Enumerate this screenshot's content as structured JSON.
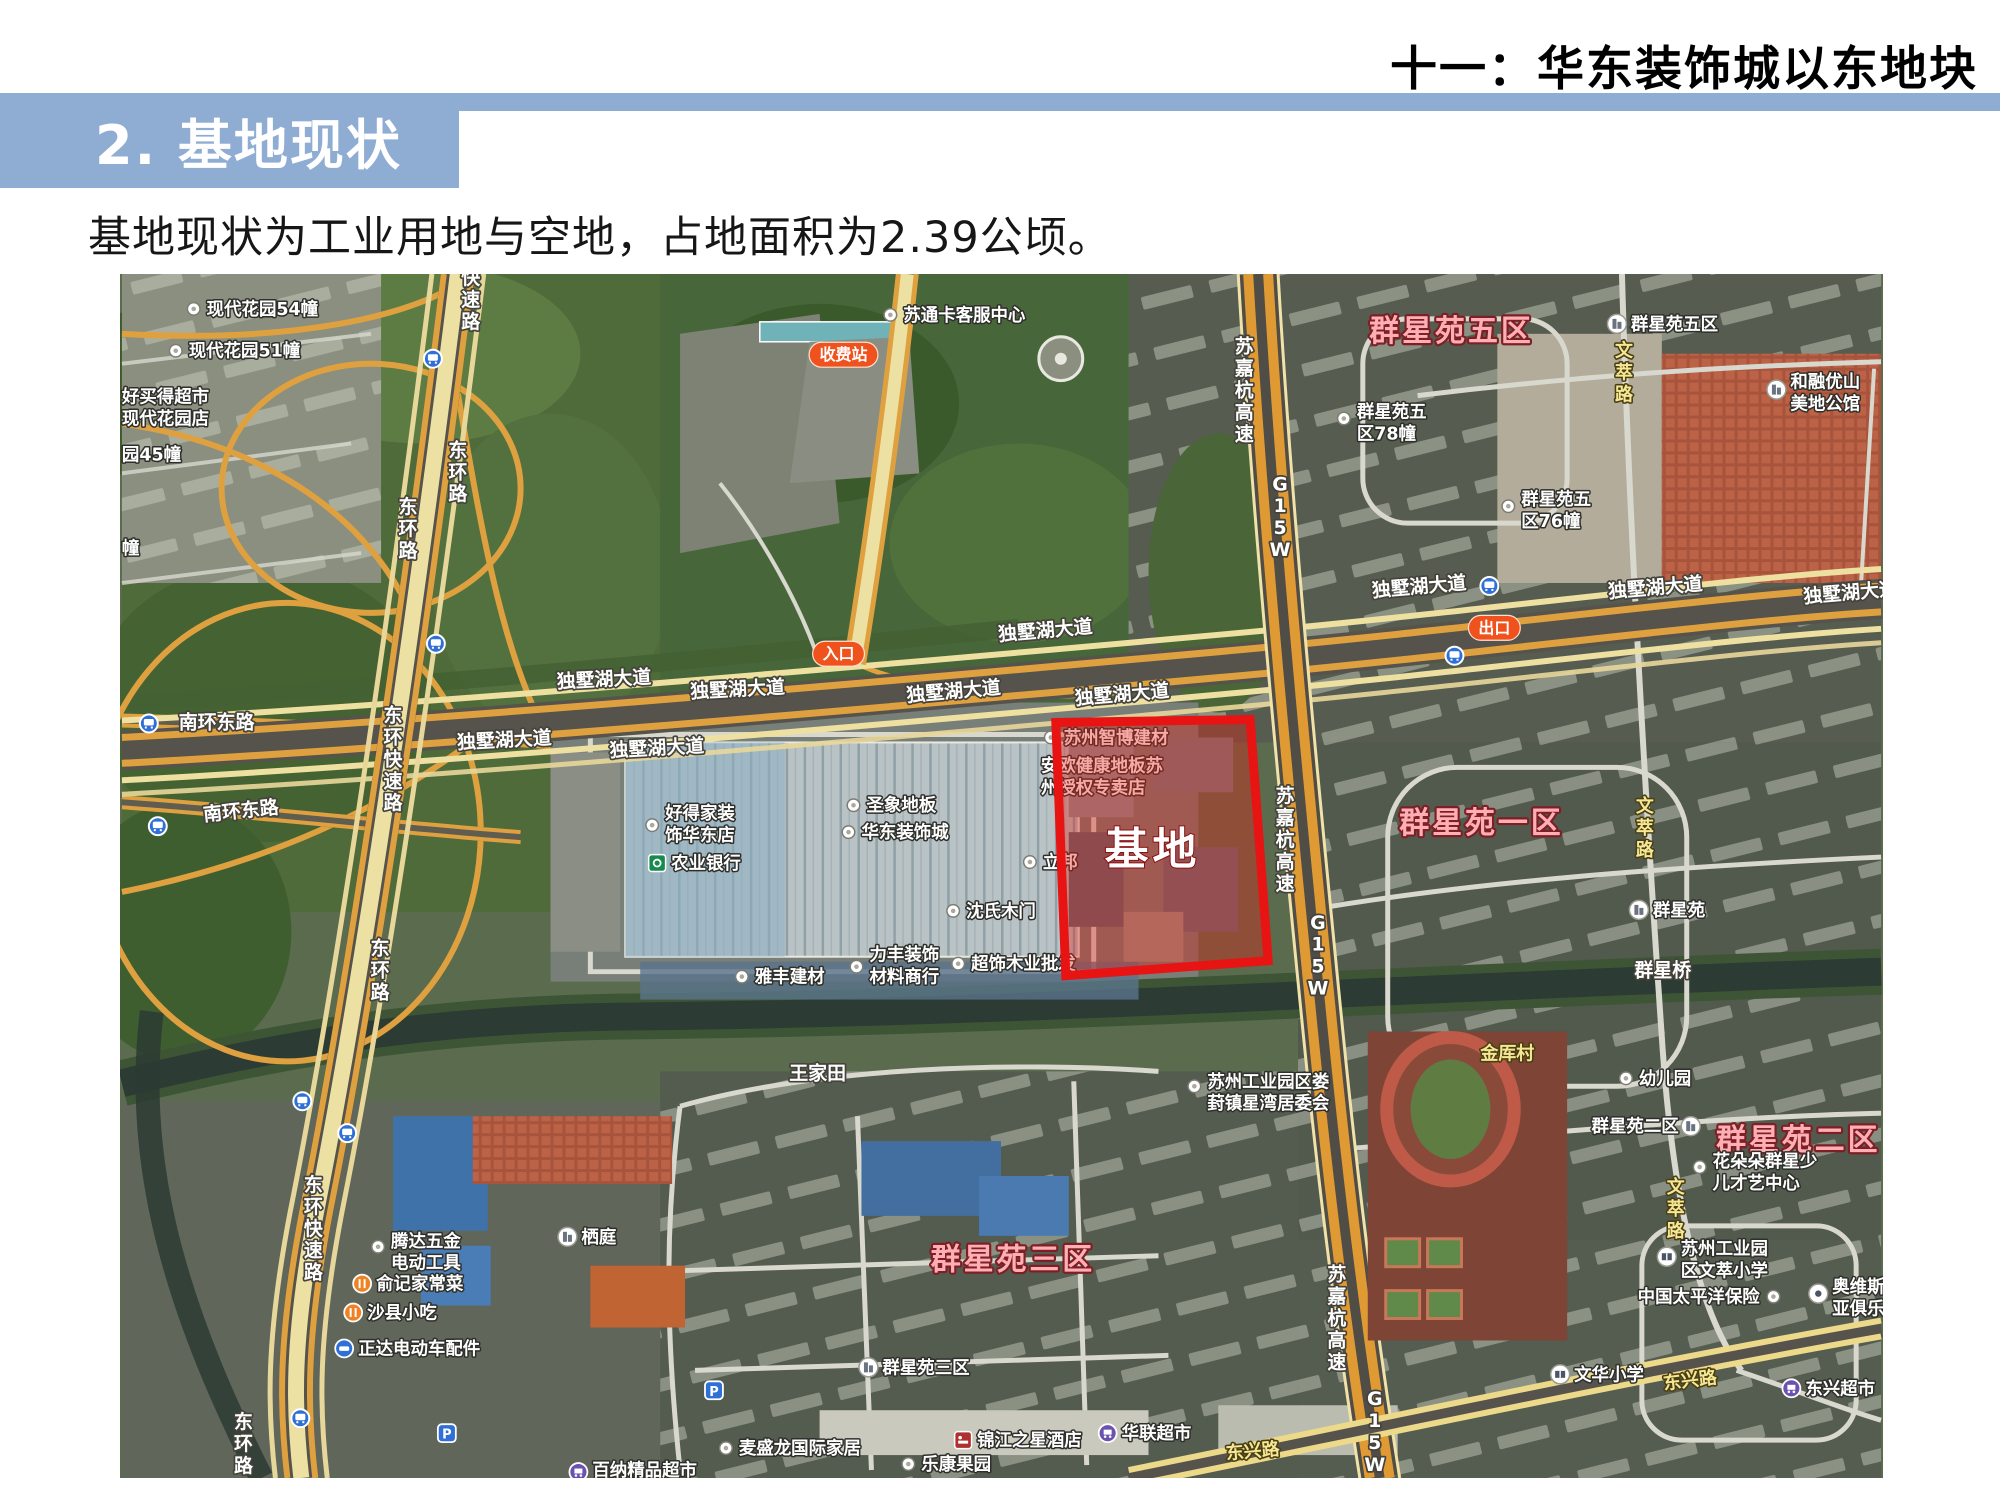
{
  "header": {
    "title": "十一：华东装饰城以东地块"
  },
  "banner": {
    "title": "2. 基地现状"
  },
  "body": {
    "text": "基地现状为工业用地与空地，占地面积为2.39公顷。"
  },
  "colors": {
    "banner_blue": "#8FACD3",
    "site_red": "#E81313",
    "road_orange": "#DFA13F"
  },
  "site": {
    "label": "基地",
    "points": "937,450 1132,447 1150,689 947,704",
    "label_x": 1034,
    "label_y": 592,
    "border_color": "#e81313",
    "fill_color": "rgba(228,32,22,0.38)"
  },
  "map": {
    "badges": [
      {
        "n": "toll-station-badge",
        "t": "收费站",
        "x": 724,
        "y": 81
      },
      {
        "n": "entrance-badge",
        "t": "入口",
        "x": 719,
        "y": 381
      },
      {
        "n": "exit-badge",
        "t": "出口",
        "x": 1377,
        "y": 355
      }
    ],
    "labels": [
      {
        "t": "独墅湖大道",
        "x": 484,
        "y": 413,
        "k": "road",
        "r": -3
      },
      {
        "t": "独墅湖大道",
        "x": 618,
        "y": 423,
        "k": "road",
        "r": -3
      },
      {
        "t": "独墅湖大道",
        "x": 835,
        "y": 425,
        "k": "road",
        "r": -5
      },
      {
        "t": "独墅湖大道",
        "x": 1004,
        "y": 428,
        "k": "road",
        "r": -5
      },
      {
        "t": "独墅湖大道",
        "x": 927,
        "y": 364,
        "k": "road",
        "r": -5
      },
      {
        "t": "独墅湖大道",
        "x": 1302,
        "y": 320,
        "k": "road",
        "r": -5
      },
      {
        "t": "独墅湖大道",
        "x": 1539,
        "y": 321,
        "k": "road",
        "r": -5
      },
      {
        "t": "独墅湖大道",
        "x": 1735,
        "y": 326,
        "k": "road",
        "r": -5
      },
      {
        "t": "独墅湖大道",
        "x": 384,
        "y": 474,
        "k": "road",
        "r": -3
      },
      {
        "t": "独墅湖大道",
        "x": 537,
        "y": 482,
        "k": "road",
        "r": -3
      },
      {
        "t": "南环东路",
        "x": 95,
        "y": 456,
        "k": "road"
      },
      {
        "t": "南环东路",
        "x": 120,
        "y": 545,
        "k": "road",
        "r": -6
      },
      {
        "t": "王家田",
        "x": 698,
        "y": 808,
        "k": "road"
      },
      {
        "t": "群星桥",
        "x": 1546,
        "y": 705,
        "k": "road"
      },
      {
        "t": "快速路",
        "x": 350,
        "y": 32,
        "k": "road",
        "v": 1
      },
      {
        "t": "东环路",
        "x": 337,
        "y": 205,
        "k": "road",
        "v": 1
      },
      {
        "t": "东环路",
        "x": 287,
        "y": 262,
        "k": "road",
        "v": 1
      },
      {
        "t": "东环快速路",
        "x": 272,
        "y": 493,
        "k": "road",
        "v": 1
      },
      {
        "t": "东环路",
        "x": 259,
        "y": 705,
        "k": "road",
        "v": 1
      },
      {
        "t": "东环快速路",
        "x": 192,
        "y": 964,
        "k": "road",
        "v": 1
      },
      {
        "t": "东环路",
        "x": 122,
        "y": 1180,
        "k": "road",
        "v": 1
      },
      {
        "t": "苏嘉杭高速",
        "x": 1126,
        "y": 123,
        "k": "road",
        "v": 1
      },
      {
        "t": "G15W",
        "x": 1162,
        "y": 250,
        "k": "road",
        "v": 1
      },
      {
        "t": "苏嘉杭高速",
        "x": 1167,
        "y": 574,
        "k": "road",
        "v": 1
      },
      {
        "t": "G15W",
        "x": 1200,
        "y": 690,
        "k": "road",
        "v": 1
      },
      {
        "t": "苏嘉杭高速",
        "x": 1219,
        "y": 1054,
        "k": "road",
        "v": 1
      },
      {
        "t": "G15W",
        "x": 1257,
        "y": 1168,
        "k": "road",
        "v": 1
      },
      {
        "t": "文萃路",
        "x": 1507,
        "y": 105,
        "k": "minor",
        "v": 1
      },
      {
        "t": "文萃路",
        "x": 1528,
        "y": 562,
        "k": "minor",
        "v": 1
      },
      {
        "t": "文萃路",
        "x": 1559,
        "y": 944,
        "k": "minor",
        "v": 1
      },
      {
        "t": "金厍村",
        "x": 1390,
        "y": 788,
        "k": "minor"
      },
      {
        "t": "东兴路",
        "x": 1135,
        "y": 1187,
        "k": "minor",
        "r": -5
      },
      {
        "t": "东兴路",
        "x": 1574,
        "y": 1116,
        "k": "minor",
        "r": -7
      },
      {
        "t": "群星苑五区",
        "x": 1334,
        "y": 67,
        "k": "area"
      },
      {
        "t": "群星苑一区",
        "x": 1364,
        "y": 561,
        "k": "area"
      },
      {
        "t": "群星苑三区",
        "x": 894,
        "y": 999,
        "k": "area"
      },
      {
        "t": "群星苑二区",
        "x": 1682,
        "y": 879,
        "k": "area"
      },
      {
        "t": "现代花园54幢",
        "x": 85,
        "y": 41,
        "k": "poi",
        "a": "start"
      },
      {
        "t": "现代花园51幢",
        "x": 67,
        "y": 83,
        "k": "poi",
        "a": "start"
      },
      {
        "t": [
          "好买得超市",
          "现代花园店"
        ],
        "x": 0,
        "y": 129,
        "k": "poi",
        "a": "start"
      },
      {
        "t": "园45幢",
        "x": 0,
        "y": 187,
        "k": "poi",
        "a": "start"
      },
      {
        "t": "幢",
        "x": 0,
        "y": 281,
        "k": "poi",
        "a": "start"
      },
      {
        "t": "苏通卡客服中心",
        "x": 784,
        "y": 47,
        "k": "poi",
        "a": "start"
      },
      {
        "t": [
          "好得家装",
          "饰华东店"
        ],
        "x": 545,
        "y": 547,
        "k": "poi",
        "a": "start"
      },
      {
        "t": "农业银行",
        "x": 551,
        "y": 597,
        "k": "poi",
        "a": "start"
      },
      {
        "t": "圣象地板",
        "x": 747,
        "y": 539,
        "k": "poi",
        "a": "start"
      },
      {
        "t": "华东装饰城",
        "x": 742,
        "y": 566,
        "k": "poi",
        "a": "start"
      },
      {
        "t": "沈氏木门",
        "x": 847,
        "y": 645,
        "k": "poi",
        "a": "start"
      },
      {
        "t": "雅丰建材",
        "x": 635,
        "y": 711,
        "k": "poi",
        "a": "start"
      },
      {
        "t": [
          "力丰装饰",
          "材料商行"
        ],
        "x": 750,
        "y": 689,
        "k": "poi",
        "a": "start"
      },
      {
        "t": "超饰木业批发",
        "x": 852,
        "y": 698,
        "k": "poi",
        "a": "start"
      },
      {
        "t": "苏州智博建材",
        "x": 945,
        "y": 471,
        "k": "poi",
        "a": "start"
      },
      {
        "t": [
          "安欧健康地板苏",
          "州授权专卖店"
        ],
        "x": 922,
        "y": 499,
        "k": "poi",
        "a": "start"
      },
      {
        "t": "立邦",
        "x": 924,
        "y": 596,
        "k": "poi",
        "a": "start"
      },
      {
        "t": [
          "群星苑五",
          "区78幢"
        ],
        "x": 1239,
        "y": 144,
        "k": "poi",
        "a": "start"
      },
      {
        "t": [
          "群星苑五",
          "区76幢"
        ],
        "x": 1404,
        "y": 232,
        "k": "poi",
        "a": "start"
      },
      {
        "t": "群星苑五区",
        "x": 1514,
        "y": 56,
        "k": "poi",
        "a": "start"
      },
      {
        "t": [
          "和融优山",
          "美地公馆"
        ],
        "x": 1674,
        "y": 114,
        "k": "poi",
        "a": "start"
      },
      {
        "t": "群星苑",
        "x": 1536,
        "y": 644,
        "k": "poi",
        "a": "start"
      },
      {
        "t": "幼儿园",
        "x": 1522,
        "y": 813,
        "k": "poi",
        "a": "start"
      },
      {
        "t": [
          "苏州工业园区娄",
          "葑镇星湾居委会"
        ],
        "x": 1089,
        "y": 816,
        "k": "poi",
        "a": "start"
      },
      {
        "t": [
          "花朵朵群星少",
          "儿才艺中心"
        ],
        "x": 1596,
        "y": 896,
        "k": "poi",
        "a": "start"
      },
      {
        "t": "群星苑二区",
        "x": 1562,
        "y": 861,
        "k": "poi",
        "a": "end"
      },
      {
        "t": [
          "苏州工业园",
          "区文萃小学"
        ],
        "x": 1564,
        "y": 984,
        "k": "poi",
        "a": "start"
      },
      {
        "t": "中国太平洋保险",
        "x": 1582,
        "y": 1032,
        "k": "poi"
      },
      {
        "t": [
          "奥维斯",
          "亚俱乐"
        ],
        "x": 1716,
        "y": 1022,
        "k": "poi",
        "a": "start"
      },
      {
        "t": "文华小学",
        "x": 1457,
        "y": 1110,
        "k": "poi",
        "a": "start"
      },
      {
        "t": "东兴超市",
        "x": 1689,
        "y": 1124,
        "k": "poi",
        "a": "start"
      },
      {
        "t": [
          "腾达五金",
          "电动工具"
        ],
        "x": 270,
        "y": 976,
        "k": "poi",
        "a": "start"
      },
      {
        "t": "俞记家常菜",
        "x": 255,
        "y": 1019,
        "k": "poi",
        "a": "start"
      },
      {
        "t": "沙县小吃",
        "x": 246,
        "y": 1048,
        "k": "poi",
        "a": "start"
      },
      {
        "t": "正达电动车配件",
        "x": 237,
        "y": 1084,
        "k": "poi",
        "a": "start"
      },
      {
        "t": "栖庭",
        "x": 461,
        "y": 972,
        "k": "poi",
        "a": "start"
      },
      {
        "t": "群星苑三区",
        "x": 763,
        "y": 1103,
        "k": "poi",
        "a": "start"
      },
      {
        "t": "麦盛龙国际家居",
        "x": 619,
        "y": 1184,
        "k": "poi",
        "a": "start"
      },
      {
        "t": "乐康果园",
        "x": 802,
        "y": 1200,
        "k": "poi",
        "a": "start"
      },
      {
        "t": "锦江之星酒店",
        "x": 858,
        "y": 1176,
        "k": "poi",
        "a": "start"
      },
      {
        "t": "华联超市",
        "x": 1003,
        "y": 1169,
        "k": "poi",
        "a": "start"
      },
      {
        "t": "百纳精品超市",
        "x": 472,
        "y": 1206,
        "k": "poi",
        "a": "start"
      }
    ],
    "icons": [
      {
        "t": "dot",
        "x": 72,
        "y": 35
      },
      {
        "t": "dot",
        "x": 54,
        "y": 77
      },
      {
        "t": "dot",
        "x": 771,
        "y": 41
      },
      {
        "t": "dot",
        "x": 734,
        "y": 533
      },
      {
        "t": "dot",
        "x": 729,
        "y": 560
      },
      {
        "t": "dot",
        "x": 834,
        "y": 639
      },
      {
        "t": "dot",
        "x": 622,
        "y": 705
      },
      {
        "t": "dot",
        "x": 839,
        "y": 692
      },
      {
        "t": "dot",
        "x": 932,
        "y": 465
      },
      {
        "t": "dot",
        "x": 911,
        "y": 590
      },
      {
        "t": "dot",
        "x": 1509,
        "y": 807
      },
      {
        "t": "dot",
        "x": 606,
        "y": 1178
      },
      {
        "t": "dot",
        "x": 789,
        "y": 1194
      },
      {
        "t": "dot",
        "x": 1226,
        "y": 145
      },
      {
        "t": "dot",
        "x": 1391,
        "y": 233
      },
      {
        "t": "dot",
        "x": 1076,
        "y": 815
      },
      {
        "t": "dot",
        "x": 1583,
        "y": 896
      },
      {
        "t": "dot",
        "x": 257,
        "y": 976
      },
      {
        "t": "dot",
        "x": 1657,
        "y": 1026
      },
      {
        "t": "dot",
        "x": 532,
        "y": 553
      },
      {
        "t": "dot",
        "x": 737,
        "y": 695
      },
      {
        "t": "bank",
        "x": 537,
        "y": 591
      },
      {
        "t": "building",
        "x": 1500,
        "y": 50
      },
      {
        "t": "building",
        "x": 1522,
        "y": 638
      },
      {
        "t": "building",
        "x": 749,
        "y": 1097
      },
      {
        "t": "building",
        "x": 447,
        "y": 966
      },
      {
        "t": "building",
        "x": 1660,
        "y": 116
      },
      {
        "t": "building",
        "x": 1574,
        "y": 855
      },
      {
        "t": "bus",
        "x": 312,
        "y": 85
      },
      {
        "t": "bus",
        "x": 315,
        "y": 371
      },
      {
        "t": "bus",
        "x": 27,
        "y": 451
      },
      {
        "t": "bus",
        "x": 36,
        "y": 554
      },
      {
        "t": "bus",
        "x": 1372,
        "y": 313
      },
      {
        "t": "bus",
        "x": 1337,
        "y": 383
      },
      {
        "t": "bus",
        "x": 181,
        "y": 830
      },
      {
        "t": "bus",
        "x": 226,
        "y": 862
      },
      {
        "t": "bus",
        "x": 179,
        "y": 1148
      },
      {
        "t": "parking",
        "x": 326,
        "y": 1163
      },
      {
        "t": "parking",
        "x": 594,
        "y": 1120
      },
      {
        "t": "hotel",
        "x": 844,
        "y": 1170
      },
      {
        "t": "market",
        "x": 989,
        "y": 1163
      },
      {
        "t": "market",
        "x": 458,
        "y": 1202
      },
      {
        "t": "market",
        "x": 1675,
        "y": 1118
      },
      {
        "t": "food",
        "x": 241,
        "y": 1013
      },
      {
        "t": "food",
        "x": 232,
        "y": 1042
      },
      {
        "t": "car",
        "x": 223,
        "y": 1078
      },
      {
        "t": "school",
        "x": 1443,
        "y": 1104
      },
      {
        "t": "school",
        "x": 1550,
        "y": 986
      },
      {
        "t": "leisure",
        "x": 1702,
        "y": 1023
      }
    ]
  }
}
